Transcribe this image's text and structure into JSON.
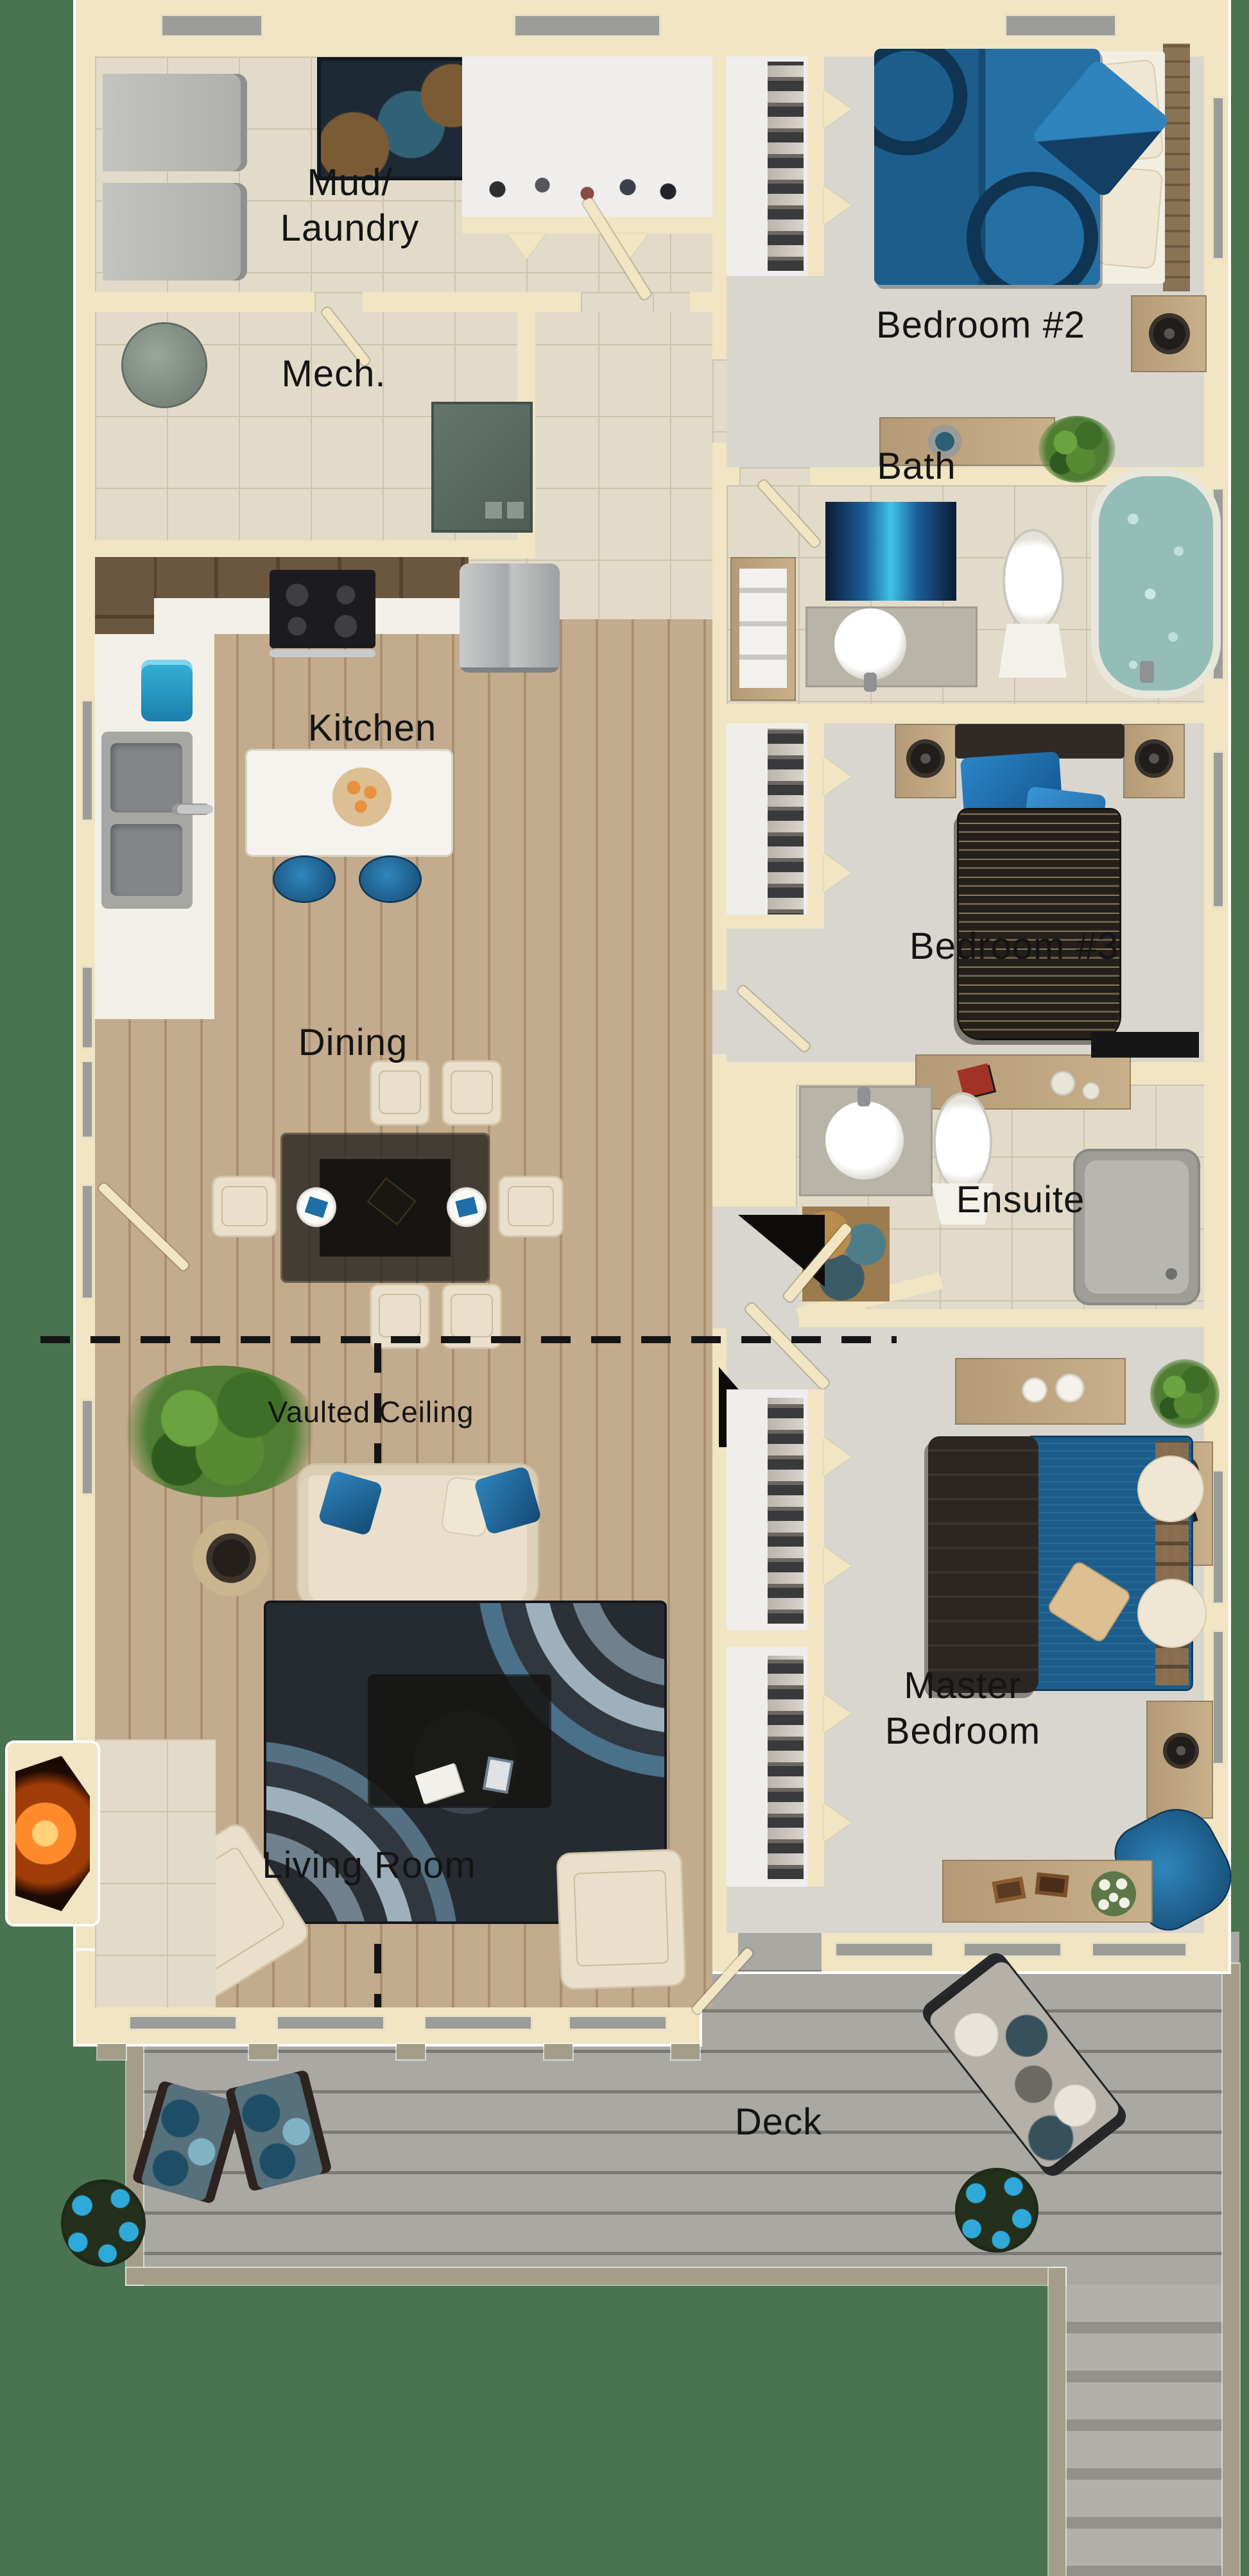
{
  "title": "Single-storey house floor plan render",
  "labels": {
    "mud1": "Mud/",
    "mud2": "Laundry",
    "mech": "Mech.",
    "bedroom2": "Bedroom #2",
    "bath": "Bath",
    "kitchen": "Kitchen",
    "bedroom3": "Bedroom #3",
    "dining": "Dining",
    "ensuite": "Ensuite",
    "vaulted": "Vaulted Ceiling",
    "master1": "Master",
    "master2": "Bedroom",
    "living": "Living Room",
    "deck": "Deck"
  },
  "colors": {
    "bg": "#4a7350",
    "wall": "#f1e5c3",
    "tile": "#e2dbc9",
    "tileLine": "#cdc4ae",
    "wood": "#c3ab8d",
    "woodSeam": "#a98f6f",
    "carpet": "#d9d6cf",
    "closet": "#efeeec",
    "deck": "#a9a8a3",
    "deckSeam": "#7b7a75",
    "stairA": "#b2b0aa",
    "stairB": "#93918b",
    "rail": "#a49d88",
    "glass": "#9c9c9a",
    "cabDark": "#5f4b37",
    "counter": "#f2f0e9",
    "stainless": "#b9babb",
    "black": "#1c1c1e",
    "sinkSteel": "#898b8d",
    "accentBlue": "#1e6fa6",
    "duvet": "#1d5d8c",
    "blanket": "#2a2420",
    "rugDark": "#262b31",
    "cream": "#e9dfcb",
    "fire": "#ff8a2a",
    "flower": "#2fa9d9",
    "leaf": "#4e7d33",
    "woodFurn": "#b49a76",
    "ink": "#141414"
  },
  "rooms": [
    {
      "name": "Mud/Laundry",
      "furniture": [
        "washer",
        "dryer",
        "area rug",
        "coat closet with shoes"
      ]
    },
    {
      "name": "Mech.",
      "furniture": [
        "water tank",
        "furnace"
      ]
    },
    {
      "name": "Bedroom #2",
      "furniture": [
        "double bed with blue duvet",
        "closet",
        "nightstand with speaker",
        "desk",
        "plant"
      ]
    },
    {
      "name": "Bath",
      "furniture": [
        "vanity sink",
        "toilet",
        "bathtub",
        "blue bath mat",
        "towel shelf"
      ]
    },
    {
      "name": "Kitchen",
      "furniture": [
        "upper cabinets",
        "stove",
        "fridge",
        "double sink",
        "island with pastry bowl",
        "two blue stools",
        "blue bin"
      ]
    },
    {
      "name": "Bedroom #3",
      "furniture": [
        "single bed with striped blanket",
        "two nightstands with speakers",
        "closet",
        "desk",
        "media console"
      ]
    },
    {
      "name": "Dining",
      "furniture": [
        "glass dining table",
        "six cream chairs",
        "two place settings"
      ]
    },
    {
      "name": "Ensuite",
      "furniture": [
        "vanity sink",
        "toilet",
        "shower",
        "patterned mat"
      ]
    },
    {
      "name": "Master Bedroom",
      "furniture": [
        "king bed with blue duvet and dark throw",
        "two nightstands",
        "two dressers",
        "blue armchair",
        "walk-in closet",
        "plant"
      ]
    },
    {
      "name": "Living Room",
      "furniture": [
        "cream sofa with blue pillows",
        "swirl rug",
        "coffee table",
        "two armchairs",
        "fireplace",
        "side table",
        "large plant"
      ]
    },
    {
      "name": "Deck",
      "furniture": [
        "patterned lounger",
        "two floral deck chairs",
        "two blue flower planters",
        "stairs"
      ]
    }
  ],
  "annotations": {
    "vaulted_ceiling_dashed_boundary": true
  }
}
